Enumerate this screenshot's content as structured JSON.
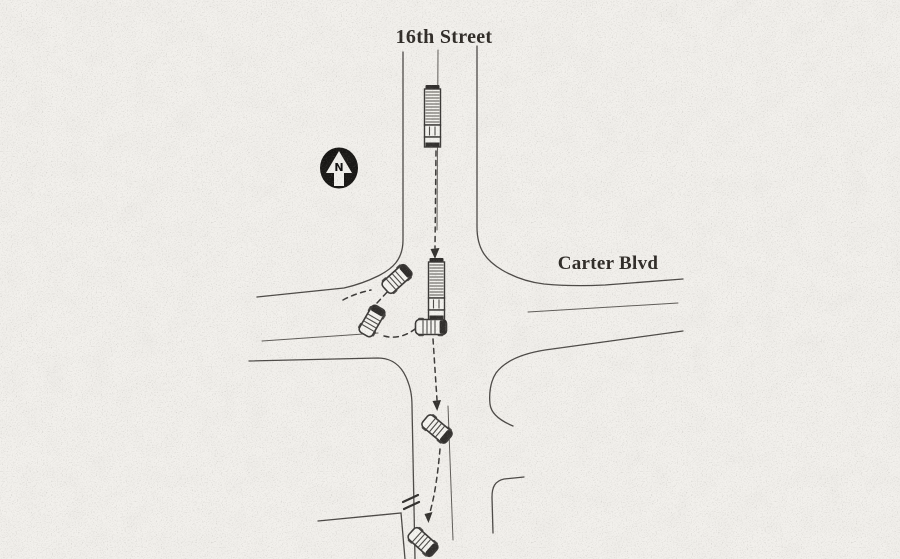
{
  "labels": {
    "vertical_street": "16th Street",
    "horizontal_street": "Carter Blvd",
    "compass_letter": "N"
  },
  "colors": {
    "paper": "#f2f0ec",
    "road_ink": "#4b4845",
    "trajectory_ink": "#3c3a38",
    "text_ink": "#2e2a26",
    "compass_fill": "#161513"
  },
  "scene": {
    "kind": "scanned traffic collision diagram",
    "intersection": "16th Street (north-south) at Carter Blvd (east-west)",
    "vehicles": [
      {
        "name": "truck-approach-north",
        "kind": "truck",
        "location": "16th Street north leg",
        "heading": "south"
      },
      {
        "name": "truck-in-intersection",
        "kind": "truck",
        "location": "intersection center",
        "heading": "south"
      },
      {
        "name": "car-position-northwest",
        "kind": "car",
        "location": "northwest corner of intersection",
        "heading": "northeast"
      },
      {
        "name": "car-position-west",
        "kind": "car",
        "location": "west side of intersection",
        "heading": "northeast"
      },
      {
        "name": "car-position-center",
        "kind": "car",
        "location": "against truck front in intersection",
        "heading": "east"
      },
      {
        "name": "car-position-south",
        "kind": "car",
        "location": "16th Street south leg",
        "heading": "southeast"
      },
      {
        "name": "car-position-far-south",
        "kind": "car",
        "location": "16th Street far south leg",
        "heading": "southeast"
      }
    ],
    "paths": [
      "dashed southbound travel path along 16th Street with down arrows",
      "dashed path linking the three car positions through the intersection",
      "dashed post-impact path continuing south to final rest position"
    ],
    "marks": [
      "double hash tick on west edge of south leg",
      "driveway corners on east side of south leg",
      "property corner line southwest of road"
    ]
  }
}
